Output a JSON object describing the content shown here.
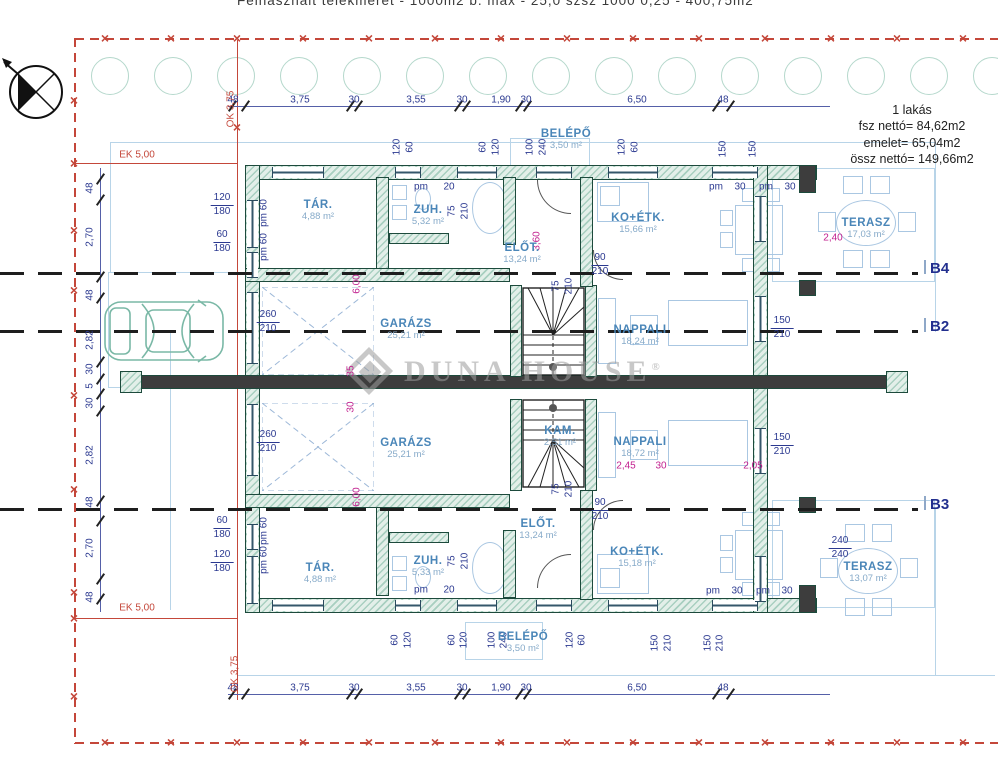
{
  "header": {
    "site_text": "Felhasznált telekméret - 1000m2 b. max - 25,0 szsz 1000 0,25 - 400,75m2"
  },
  "summary": {
    "title": "1 lakás",
    "line1": "fsz nettó= 84,62m2",
    "line2": "emelet= 65,04m2",
    "line3": "össz nettó= 149,66m2"
  },
  "watermark": {
    "brand": "Duna House",
    "reg": "®"
  },
  "sections": [
    {
      "label": "B4",
      "y": 272
    },
    {
      "label": "B2",
      "y": 330
    },
    {
      "label": "B3",
      "y": 508
    }
  ],
  "rooms": [
    {
      "n": "TÁR.",
      "a": "4,88 m²",
      "x": 318,
      "y": 211
    },
    {
      "n": "ZUH.",
      "a": "5,32 m²",
      "x": 428,
      "y": 216
    },
    {
      "n": "ELŐT.",
      "a": "13,24 m²",
      "x": 522,
      "y": 254
    },
    {
      "n": "BELÉPŐ",
      "a": "3,50 m²",
      "x": 566,
      "y": 140
    },
    {
      "n": "KO+ÉTK.",
      "a": "15,66 m²",
      "x": 638,
      "y": 224
    },
    {
      "n": "TERASZ",
      "a": "17,03 m²",
      "x": 866,
      "y": 229
    },
    {
      "n": "GARÁZS",
      "a": "25,21 m²",
      "x": 406,
      "y": 330
    },
    {
      "n": "NAPPALI",
      "a": "18,24 m²",
      "x": 640,
      "y": 336
    },
    {
      "n": "GARÁZS",
      "a": "25,21 m²",
      "x": 406,
      "y": 449
    },
    {
      "n": "KAM.",
      "a": "2,51 m²",
      "x": 560,
      "y": 437
    },
    {
      "n": "NAPPALI",
      "a": "18,72 m²",
      "x": 640,
      "y": 448
    },
    {
      "n": "ELŐT.",
      "a": "13,24 m²",
      "x": 538,
      "y": 530
    },
    {
      "n": "ZUH.",
      "a": "5,33 m²",
      "x": 428,
      "y": 567
    },
    {
      "n": "TÁR.",
      "a": "4,88 m²",
      "x": 320,
      "y": 574
    },
    {
      "n": "KO+ÉTK.",
      "a": "15,18 m²",
      "x": 637,
      "y": 558
    },
    {
      "n": "BELÉPŐ",
      "a": "3,50 m²",
      "x": 523,
      "y": 643
    },
    {
      "n": "TERASZ",
      "a": "13,07 m²",
      "x": 868,
      "y": 573
    }
  ],
  "dims": {
    "run": [
      "48",
      "3,75",
      "30",
      "3,55",
      "30",
      "1,90",
      "30",
      "6,50",
      "48"
    ],
    "top_y": 100,
    "bottom_y": 688,
    "x": [
      233,
      300,
      354,
      416,
      462,
      501,
      526,
      637,
      723
    ],
    "tick_x": [
      232,
      245,
      350,
      358,
      458,
      466,
      519,
      527,
      716,
      730
    ],
    "left_tick_y": [
      178,
      199,
      276,
      297,
      361,
      378,
      393,
      410,
      500,
      520,
      578,
      598
    ]
  },
  "annotations": [
    {
      "t": "48",
      "x": 90,
      "y": 188,
      "r": 1
    },
    {
      "t": "2,70",
      "x": 90,
      "y": 237,
      "r": 1
    },
    {
      "t": "48",
      "x": 90,
      "y": 295,
      "r": 1
    },
    {
      "t": "2,82",
      "x": 90,
      "y": 340,
      "r": 1
    },
    {
      "t": "30",
      "x": 90,
      "y": 369,
      "r": 1
    },
    {
      "t": "5",
      "x": 90,
      "y": 386,
      "r": 1
    },
    {
      "t": "30",
      "x": 90,
      "y": 403,
      "r": 1
    },
    {
      "t": "2,82",
      "x": 90,
      "y": 455,
      "r": 1
    },
    {
      "t": "48",
      "x": 90,
      "y": 502,
      "r": 1
    },
    {
      "t": "2,70",
      "x": 90,
      "y": 548,
      "r": 1
    },
    {
      "t": "48",
      "x": 90,
      "y": 597,
      "r": 1
    },
    {
      "t": "120",
      "x": 397,
      "y": 147,
      "r": 1
    },
    {
      "t": "60",
      "x": 410,
      "y": 147,
      "r": 1
    },
    {
      "t": "60",
      "x": 483,
      "y": 147,
      "r": 1
    },
    {
      "t": "120",
      "x": 496,
      "y": 147,
      "r": 1
    },
    {
      "t": "100",
      "x": 530,
      "y": 147,
      "r": 1
    },
    {
      "t": "240",
      "x": 543,
      "y": 147,
      "r": 1
    },
    {
      "t": "120",
      "x": 622,
      "y": 147,
      "r": 1
    },
    {
      "t": "60",
      "x": 635,
      "y": 147,
      "r": 1
    },
    {
      "t": "150",
      "x": 723,
      "y": 149,
      "r": 1
    },
    {
      "t": "150",
      "x": 753,
      "y": 149,
      "r": 1
    },
    {
      "t": "60",
      "x": 395,
      "y": 640,
      "r": 1
    },
    {
      "t": "120",
      "x": 408,
      "y": 640,
      "r": 1
    },
    {
      "t": "60",
      "x": 452,
      "y": 640,
      "r": 1
    },
    {
      "t": "120",
      "x": 464,
      "y": 640,
      "r": 1
    },
    {
      "t": "100",
      "x": 492,
      "y": 640,
      "r": 1
    },
    {
      "t": "240",
      "x": 504,
      "y": 640,
      "r": 1
    },
    {
      "t": "120",
      "x": 570,
      "y": 640,
      "r": 1
    },
    {
      "t": "60",
      "x": 582,
      "y": 640,
      "r": 1
    },
    {
      "t": "150",
      "x": 655,
      "y": 643,
      "r": 1
    },
    {
      "t": "210",
      "x": 668,
      "y": 643,
      "r": 1
    },
    {
      "t": "150",
      "x": 708,
      "y": 643,
      "r": 1
    },
    {
      "t": "210",
      "x": 720,
      "y": 643,
      "r": 1
    },
    {
      "t": "pm 60",
      "x": 264,
      "y": 213,
      "r": 1
    },
    {
      "t": "pm 60",
      "x": 264,
      "y": 247,
      "r": 1
    },
    {
      "t": "pm 60",
      "x": 264,
      "y": 531,
      "r": 1
    },
    {
      "t": "pm 60",
      "x": 264,
      "y": 560,
      "r": 1
    },
    {
      "t": "75",
      "x": 452,
      "y": 211,
      "r": 1
    },
    {
      "t": "210",
      "x": 465,
      "y": 211,
      "r": 1
    },
    {
      "t": "75",
      "x": 556,
      "y": 286,
      "r": 1
    },
    {
      "t": "210",
      "x": 569,
      "y": 286,
      "r": 1
    },
    {
      "t": "75",
      "x": 452,
      "y": 561,
      "r": 1
    },
    {
      "t": "210",
      "x": 465,
      "y": 561,
      "r": 1
    },
    {
      "t": "75",
      "x": 556,
      "y": 489,
      "r": 1
    },
    {
      "t": "210",
      "x": 569,
      "y": 489,
      "r": 1
    },
    {
      "t": "pm",
      "x": 421,
      "y": 187
    },
    {
      "t": "20",
      "x": 449,
      "y": 187
    },
    {
      "t": "pm",
      "x": 716,
      "y": 187
    },
    {
      "t": "30",
      "x": 740,
      "y": 187
    },
    {
      "t": "pm",
      "x": 766,
      "y": 187
    },
    {
      "t": "30",
      "x": 790,
      "y": 187
    },
    {
      "t": "pm",
      "x": 421,
      "y": 590
    },
    {
      "t": "20",
      "x": 449,
      "y": 590
    },
    {
      "t": "pm",
      "x": 713,
      "y": 591
    },
    {
      "t": "30",
      "x": 737,
      "y": 591
    },
    {
      "t": "pm",
      "x": 763,
      "y": 591
    },
    {
      "t": "30",
      "x": 787,
      "y": 591
    },
    {
      "t": "3,60",
      "x": 537,
      "y": 241,
      "r": 1,
      "c": "cm"
    },
    {
      "t": "6,00",
      "x": 357,
      "y": 284,
      "r": 1,
      "c": "cm"
    },
    {
      "t": "6,00",
      "x": 357,
      "y": 497,
      "r": 1,
      "c": "cm"
    },
    {
      "t": "35",
      "x": 351,
      "y": 371,
      "r": 1,
      "c": "cm"
    },
    {
      "t": "30",
      "x": 351,
      "y": 407,
      "r": 1,
      "c": "cm"
    },
    {
      "t": "2,45",
      "x": 626,
      "y": 466,
      "c": "cm"
    },
    {
      "t": "30",
      "x": 661,
      "y": 466,
      "c": "cm"
    },
    {
      "t": "2,05",
      "x": 753,
      "y": 466,
      "c": "cm"
    },
    {
      "t": "2,40",
      "x": 833,
      "y": 238,
      "c": "cm"
    },
    {
      "t": "EK 5,00",
      "x": 137,
      "y": 155,
      "c": "cr"
    },
    {
      "t": "EK 5,00",
      "x": 137,
      "y": 608,
      "c": "cr"
    },
    {
      "t": "OK 3,75",
      "x": 231,
      "y": 109,
      "r": 1,
      "c": "cr"
    },
    {
      "t": "OK 3,75",
      "x": 235,
      "y": 674,
      "r": 1,
      "c": "cr"
    }
  ],
  "stacks": [
    {
      "a": "120",
      "b": "180",
      "x": 222,
      "y": 205
    },
    {
      "a": "60",
      "b": "180",
      "x": 222,
      "y": 242
    },
    {
      "a": "60",
      "b": "180",
      "x": 222,
      "y": 528
    },
    {
      "a": "120",
      "b": "180",
      "x": 222,
      "y": 562
    },
    {
      "a": "260",
      "b": "210",
      "x": 268,
      "y": 322
    },
    {
      "a": "260",
      "b": "210",
      "x": 268,
      "y": 442
    },
    {
      "a": "150",
      "b": "210",
      "x": 782,
      "y": 328
    },
    {
      "a": "150",
      "b": "210",
      "x": 782,
      "y": 445
    },
    {
      "a": "240",
      "b": "240",
      "x": 840,
      "y": 548
    },
    {
      "a": "90",
      "b": "210",
      "x": 600,
      "y": 265
    },
    {
      "a": "90",
      "b": "210",
      "x": 600,
      "y": 510
    }
  ],
  "layout": {
    "walls": [
      [
        245,
        165,
        572,
        15,
        0
      ],
      [
        245,
        598,
        572,
        15,
        0
      ],
      [
        245,
        165,
        15,
        448,
        0
      ],
      [
        753,
        165,
        15,
        448,
        0
      ],
      [
        799,
        165,
        17,
        28,
        1
      ],
      [
        799,
        280,
        17,
        16,
        1
      ],
      [
        799,
        497,
        17,
        16,
        1
      ],
      [
        799,
        585,
        17,
        28,
        1
      ],
      [
        128,
        375,
        780,
        14,
        1
      ],
      [
        120,
        371,
        22,
        22,
        0
      ],
      [
        886,
        371,
        22,
        22,
        0
      ],
      [
        376,
        177,
        13,
        100,
        0
      ],
      [
        245,
        268,
        265,
        14,
        0
      ],
      [
        389,
        233,
        60,
        11,
        0
      ],
      [
        503,
        177,
        13,
        68,
        0
      ],
      [
        510,
        285,
        12,
        92,
        0
      ],
      [
        585,
        285,
        12,
        92,
        0
      ],
      [
        580,
        177,
        13,
        110,
        0
      ],
      [
        376,
        496,
        13,
        100,
        0
      ],
      [
        245,
        494,
        265,
        14,
        0
      ],
      [
        389,
        532,
        60,
        11,
        0
      ],
      [
        503,
        530,
        13,
        68,
        0
      ],
      [
        510,
        399,
        12,
        92,
        0
      ],
      [
        585,
        399,
        12,
        92,
        0
      ],
      [
        580,
        490,
        13,
        110,
        0
      ]
    ],
    "windows": [
      [
        272,
        167,
        52,
        11
      ],
      [
        395,
        167,
        26,
        11
      ],
      [
        457,
        167,
        40,
        11
      ],
      [
        536,
        167,
        36,
        11
      ],
      [
        608,
        167,
        50,
        11
      ],
      [
        712,
        167,
        46,
        11
      ],
      [
        272,
        600,
        52,
        11
      ],
      [
        395,
        600,
        26,
        11
      ],
      [
        457,
        600,
        40,
        11
      ],
      [
        536,
        600,
        36,
        11
      ],
      [
        608,
        600,
        50,
        11
      ],
      [
        712,
        600,
        46,
        11
      ],
      [
        247,
        200,
        11,
        48
      ],
      [
        247,
        252,
        11,
        26
      ],
      [
        247,
        292,
        11,
        72
      ],
      [
        247,
        404,
        11,
        72
      ],
      [
        247,
        524,
        11,
        26
      ],
      [
        247,
        556,
        11,
        48
      ],
      [
        755,
        196,
        11,
        46
      ],
      [
        755,
        296,
        11,
        46
      ],
      [
        755,
        428,
        11,
        46
      ],
      [
        755,
        556,
        11,
        46
      ]
    ],
    "arcs": [
      [
        537,
        180,
        34,
        "bl"
      ],
      [
        537,
        554,
        34,
        "tl"
      ],
      [
        593,
        250,
        30,
        "bl"
      ],
      [
        593,
        500,
        30,
        "tl"
      ]
    ],
    "site_lines": [
      [
        110,
        142,
        825,
        1
      ],
      [
        110,
        142,
        1,
        130
      ],
      [
        935,
        142,
        1,
        190
      ],
      [
        935,
        508,
        1,
        168
      ],
      [
        170,
        330,
        1,
        280
      ],
      [
        238,
        675,
        757,
        1
      ]
    ],
    "site_rects": [
      [
        772,
        168,
        163,
        114
      ],
      [
        772,
        500,
        163,
        108
      ],
      [
        108,
        272,
        130,
        116
      ],
      [
        510,
        138,
        80,
        30
      ],
      [
        465,
        622,
        78,
        38
      ]
    ],
    "red_dash": [
      {
        "o": "h",
        "x": 75,
        "y": 38,
        "l": 923
      },
      {
        "o": "h",
        "x": 75,
        "y": 742,
        "l": 923
      },
      {
        "o": "v",
        "x": 74,
        "y": 38,
        "l": 706
      }
    ],
    "red_solid": [
      [
        75,
        163,
        162,
        1
      ],
      [
        75,
        618,
        162,
        1
      ],
      [
        237,
        40,
        1,
        660
      ]
    ],
    "xmarks_top": [
      105,
      171,
      237,
      303,
      369,
      435,
      501,
      567,
      633,
      699,
      765,
      831,
      897,
      963
    ],
    "xmarks_bottom": [
      105,
      171,
      237,
      303,
      369,
      435,
      501,
      567,
      633,
      699,
      765,
      831,
      897,
      963
    ],
    "xmarks_left": [
      100,
      163,
      230,
      290,
      395,
      489,
      592,
      618,
      696
    ],
    "xmark_extra": [
      237,
      127
    ],
    "trees": {
      "count": 15,
      "x0": 110,
      "dx": 63,
      "cy": 76,
      "r": 19
    },
    "furniture": [
      {
        "k": "rect",
        "b": [
          735,
          205,
          48,
          50
        ]
      },
      {
        "k": "rect",
        "b": [
          742,
          188,
          16,
          14
        ]
      },
      {
        "k": "rect",
        "b": [
          764,
          188,
          16,
          14
        ]
      },
      {
        "k": "rect",
        "b": [
          720,
          210,
          13,
          16
        ]
      },
      {
        "k": "rect",
        "b": [
          720,
          232,
          13,
          16
        ]
      },
      {
        "k": "rect",
        "b": [
          742,
          258,
          16,
          14
        ]
      },
      {
        "k": "rect",
        "b": [
          764,
          258,
          16,
          14
        ]
      },
      {
        "k": "oval",
        "b": [
          836,
          200,
          60,
          46
        ]
      },
      {
        "k": "rect",
        "b": [
          843,
          176,
          20,
          18
        ]
      },
      {
        "k": "rect",
        "b": [
          870,
          176,
          20,
          18
        ]
      },
      {
        "k": "rect",
        "b": [
          818,
          212,
          18,
          20
        ]
      },
      {
        "k": "rect",
        "b": [
          898,
          212,
          18,
          20
        ]
      },
      {
        "k": "rect",
        "b": [
          843,
          250,
          20,
          18
        ]
      },
      {
        "k": "rect",
        "b": [
          870,
          250,
          20,
          18
        ]
      },
      {
        "k": "oval",
        "b": [
          838,
          548,
          60,
          46
        ]
      },
      {
        "k": "rect",
        "b": [
          845,
          524,
          20,
          18
        ]
      },
      {
        "k": "rect",
        "b": [
          872,
          524,
          20,
          18
        ]
      },
      {
        "k": "rect",
        "b": [
          820,
          558,
          18,
          20
        ]
      },
      {
        "k": "rect",
        "b": [
          900,
          558,
          18,
          20
        ]
      },
      {
        "k": "rect",
        "b": [
          845,
          598,
          20,
          18
        ]
      },
      {
        "k": "rect",
        "b": [
          872,
          598,
          20,
          18
        ]
      },
      {
        "k": "rect",
        "b": [
          735,
          530,
          48,
          50
        ]
      },
      {
        "k": "rect",
        "b": [
          742,
          512,
          16,
          14
        ]
      },
      {
        "k": "rect",
        "b": [
          764,
          512,
          16,
          14
        ]
      },
      {
        "k": "rect",
        "b": [
          720,
          535,
          13,
          16
        ]
      },
      {
        "k": "rect",
        "b": [
          720,
          557,
          13,
          16
        ]
      },
      {
        "k": "rect",
        "b": [
          742,
          582,
          16,
          14
        ]
      },
      {
        "k": "rect",
        "b": [
          764,
          582,
          16,
          14
        ]
      },
      {
        "k": "rect",
        "b": [
          598,
          298,
          18,
          66
        ]
      },
      {
        "k": "rect",
        "b": [
          668,
          300,
          80,
          46
        ]
      },
      {
        "k": "rect",
        "b": [
          630,
          315,
          28,
          30
        ]
      },
      {
        "k": "rect",
        "b": [
          598,
          412,
          18,
          66
        ]
      },
      {
        "k": "rect",
        "b": [
          668,
          420,
          80,
          46
        ]
      },
      {
        "k": "rect",
        "b": [
          630,
          430,
          28,
          30
        ]
      },
      {
        "k": "rect",
        "b": [
          597,
          182,
          52,
          40
        ]
      },
      {
        "k": "rect",
        "b": [
          600,
          186,
          20,
          20
        ]
      },
      {
        "k": "rect",
        "b": [
          597,
          554,
          52,
          40
        ]
      },
      {
        "k": "rect",
        "b": [
          600,
          568,
          20,
          20
        ]
      },
      {
        "k": "oval",
        "b": [
          472,
          182,
          36,
          52
        ]
      },
      {
        "k": "rect",
        "b": [
          392,
          185,
          15,
          15
        ]
      },
      {
        "k": "rect",
        "b": [
          392,
          205,
          15,
          15
        ]
      },
      {
        "k": "oval",
        "b": [
          415,
          188,
          16,
          22
        ]
      },
      {
        "k": "oval",
        "b": [
          472,
          542,
          36,
          52
        ]
      },
      {
        "k": "rect",
        "b": [
          392,
          556,
          15,
          15
        ]
      },
      {
        "k": "rect",
        "b": [
          392,
          576,
          15,
          15
        ]
      },
      {
        "k": "oval",
        "b": [
          415,
          566,
          16,
          22
        ]
      }
    ]
  }
}
